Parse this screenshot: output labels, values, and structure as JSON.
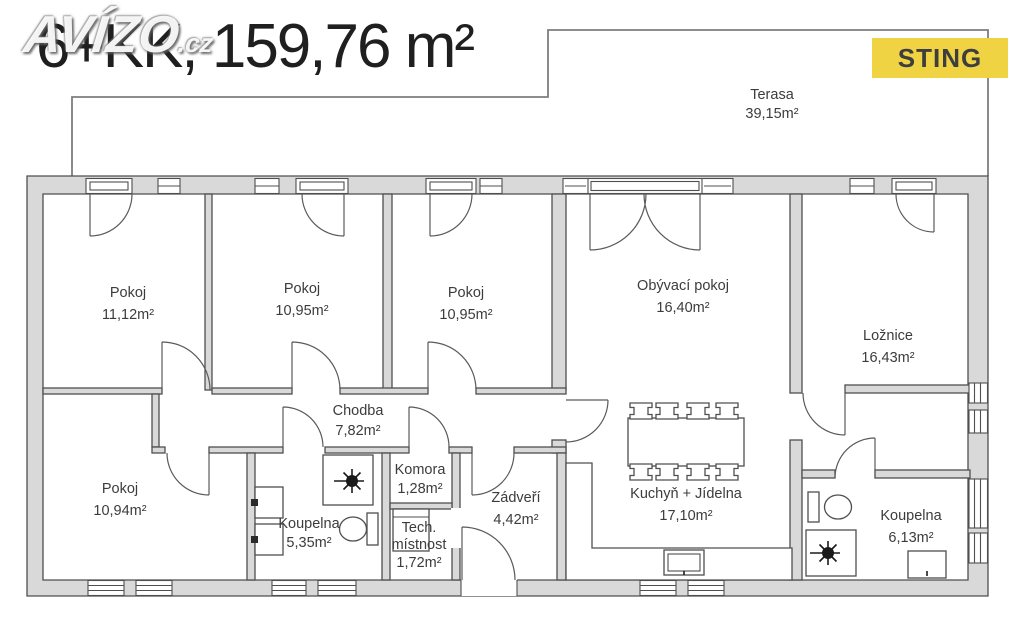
{
  "header": {
    "watermark": "AVÍZO",
    "watermark_suffix": ".cz",
    "title": "6+KK, 159,76 m²",
    "badge": "STING"
  },
  "colors": {
    "wall_fill": "#d9d9d9",
    "line": "#4f4f4f",
    "badge_bg": "#f0d343",
    "badge_text": "#3e3e3e"
  },
  "plan": {
    "type": "floorplan",
    "layout": "6+KK",
    "total_area": "159,76 m²",
    "rooms": {
      "terasa": {
        "name": "Terasa",
        "area": "39,15m²"
      },
      "pokoj1": {
        "name": "Pokoj",
        "area": "11,12m²"
      },
      "pokoj2": {
        "name": "Pokoj",
        "area": "10,95m²"
      },
      "pokoj3": {
        "name": "Pokoj",
        "area": "10,95m²"
      },
      "obyvaci": {
        "name": "Obývací pokoj",
        "area": "16,40m²"
      },
      "loznice": {
        "name": "Ložnice",
        "area": "16,43m²"
      },
      "chodba": {
        "name": "Chodba",
        "area": "7,82m²"
      },
      "pokoj4": {
        "name": "Pokoj",
        "area": "10,94m²"
      },
      "koupelna1": {
        "name": "Koupelna",
        "area": "5,35m²"
      },
      "komora": {
        "name": "Komora",
        "area": "1,28m²"
      },
      "tech": {
        "name": "Tech.",
        "name2": "místnost",
        "area": "1,72m²"
      },
      "zadveri": {
        "name": "Zádveří",
        "area": "4,42m²"
      },
      "kuchyn": {
        "name": "Kuchyň + Jídelna",
        "area": "17,10m²"
      },
      "koupelna2": {
        "name": "Koupelna",
        "area": "6,13m²"
      }
    }
  }
}
